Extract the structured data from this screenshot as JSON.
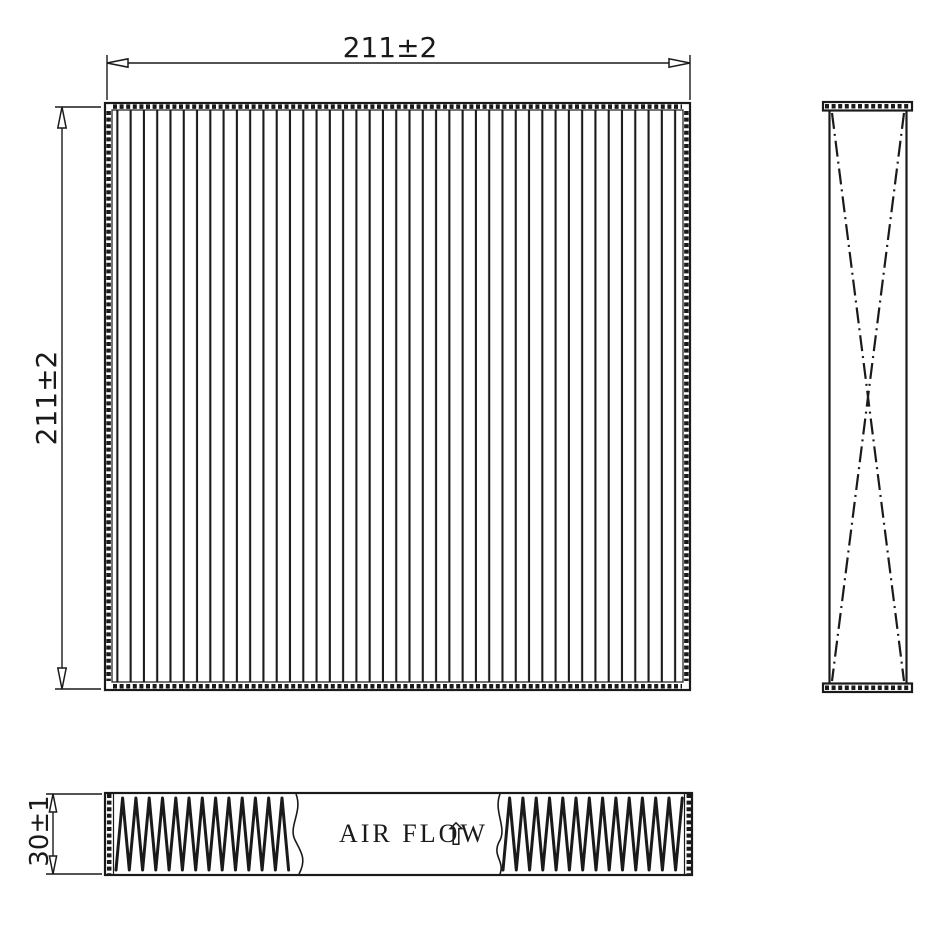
{
  "drawing": {
    "front_view": {
      "width_dim_label": "211±2",
      "height_dim_label": "211±2",
      "pleat_count": 43
    },
    "bottom_view": {
      "depth_dim_label": "30±1",
      "air_flow_label": "AIR FLOW",
      "air_flow_arrow": "⇧"
    },
    "colors": {
      "line": "#1a1a1a",
      "background": "#ffffff"
    }
  }
}
